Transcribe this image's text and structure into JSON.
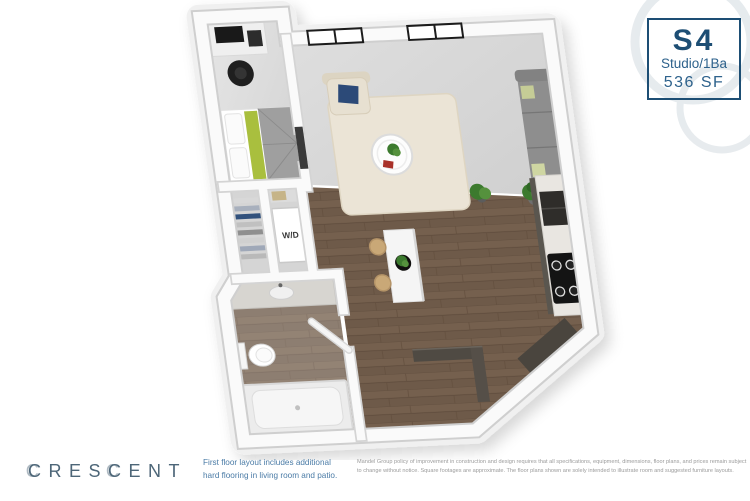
{
  "colors": {
    "accent": "#1d4e74",
    "accent-light": "#2e628c",
    "logo": "#4d6678",
    "note": "#4a7ba6",
    "disclaimer": "#9b9b9b"
  },
  "unit": {
    "code": "S4",
    "type": "Studio/1Ba",
    "area": "536 SF"
  },
  "brand": {
    "name": "CRESCENT"
  },
  "floor_plan": {
    "washer_dryer_label": "W/D"
  },
  "footer": {
    "note": "First floor layout includes additional\nhard flooring in living room and patio.",
    "disclaimer": "Mandel Group policy of improvement in construction and design requires that all specifications, equipment, dimensions, floor plans, and prices remain subject to change without notice. Square footages are approximate. The floor plans shown are solely intended to illustrate room and suggested furniture layouts."
  }
}
